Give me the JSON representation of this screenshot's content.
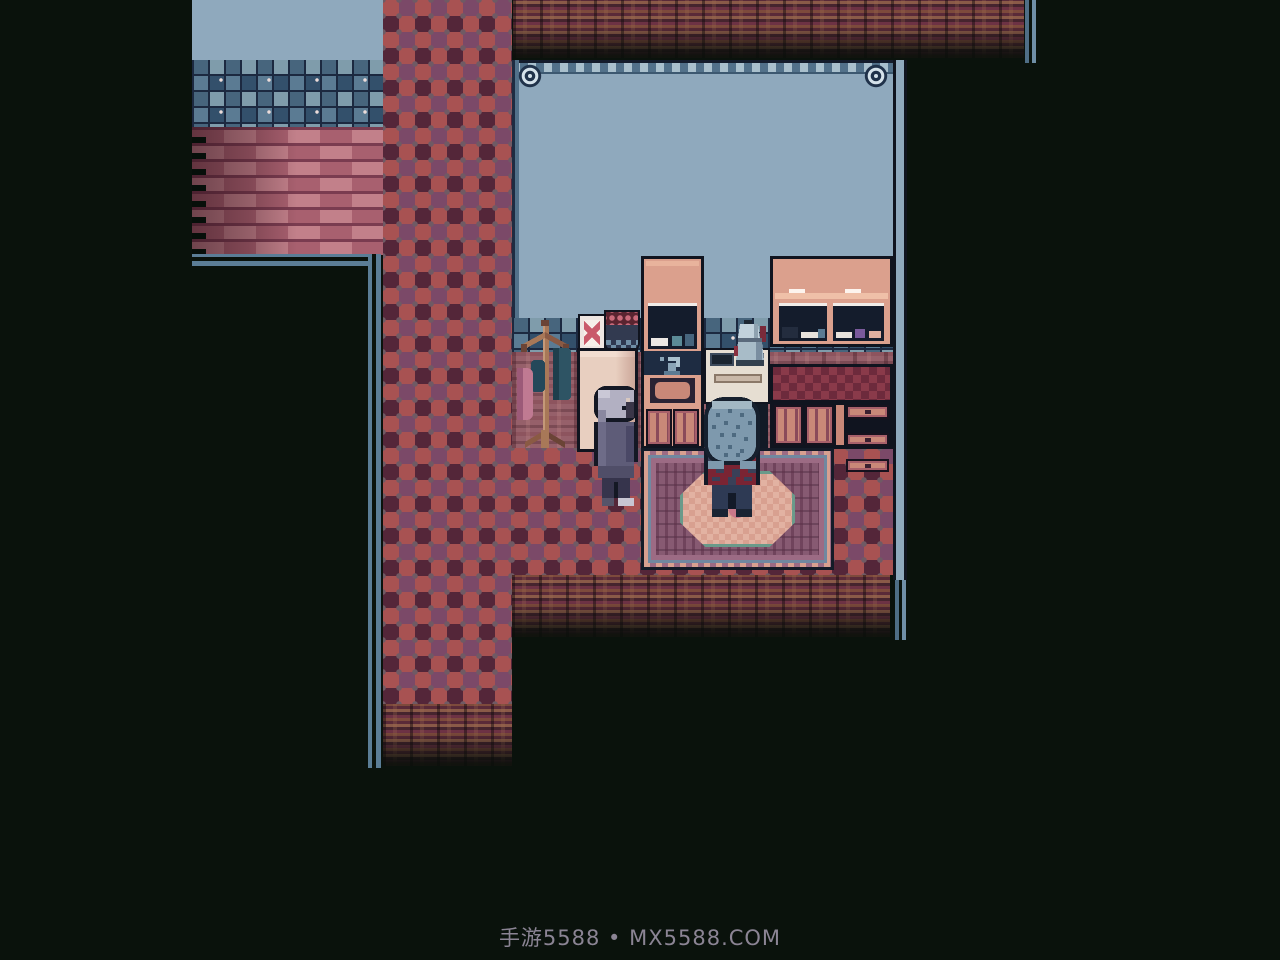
{
  "meta": {
    "app": "pixel-art RPG game screen",
    "scene": "kitchen interior viewed top-down, surrounded by darkness"
  },
  "watermark": {
    "text": "手游5588 • MX5588.COM",
    "color": "#8b8494"
  },
  "palette": {
    "background": "#0a120c",
    "room_wall": "#8fa9bd",
    "wall_border": "#52718a",
    "wall_border_dash": "#a9c0cd",
    "outline": "#10141f",
    "mosaic_grout": "#1c2940",
    "mosaic_blues": [
      "#33506b",
      "#47657d",
      "#5b7b93",
      "#7f9cab"
    ],
    "floor_checker_salmon": "#a85252",
    "floor_checker_maroon": "#542639",
    "floor_checker_purple": "#7b4968",
    "brick_light": "#c2808a",
    "brick_dark": "#a8606f",
    "brick_mortar": "#7a3c50",
    "dirt_browns": [
      "#8a5a48",
      "#6d3244",
      "#5a2a38",
      "#7a4a3c"
    ],
    "ledge_line_blue": "#5b7d96",
    "furniture_pink": "#dba08d",
    "cabinet_pink": "#c98878",
    "cabinet_maroon": "#8a4a5a",
    "counter_check_red": "#8a3a4a",
    "counter_check_dark": "#6d2a3c",
    "rug_field": "#875a72",
    "rug_border_pink": "#d8a090",
    "rug_teal": "#6a9a8a",
    "rug_blue": "#7088a0",
    "npc_hair_gray": "#b2b0c2",
    "npc_coat": "#5e5c78",
    "player_hair_blue": "#7e99ad",
    "player_shirt_plaid_red": "#7a2433",
    "player_pants_navy": "#2e3a54"
  },
  "scene": {
    "objects": [
      {
        "name": "coat-rack",
        "desc": "wooden stand with hanging teal coats and a pink bag"
      },
      {
        "name": "refrigerator",
        "desc": "cream fridge with a picture frame and a berry pot on top"
      },
      {
        "name": "sink-hutch",
        "desc": "pink hutch with dish shelf, faucet, basin and cabinet doors"
      },
      {
        "name": "stove",
        "desc": "white stove with a silver kettle on the burner"
      },
      {
        "name": "wide-hutch",
        "desc": "wide pink hutch with dishes and pots on two shelves"
      },
      {
        "name": "checkered-counter",
        "desc": "counter with red checkered cloth, doors and drawers below"
      },
      {
        "name": "rug",
        "desc": "ornate purple rug with salmon and teal medallion"
      },
      {
        "name": "brick-wall",
        "desc": "exterior pink brick wall with mosaic tile band above"
      },
      {
        "name": "checker-path",
        "desc": "red and purple checkerboard floor column"
      }
    ],
    "characters": [
      {
        "name": "npc-gray-hair",
        "desc": "gray-haired person in a dark coat facing right"
      },
      {
        "name": "player-blue-hair",
        "desc": "blue-haired person in red plaid shirt seen from behind, standing on the rug"
      }
    ]
  }
}
